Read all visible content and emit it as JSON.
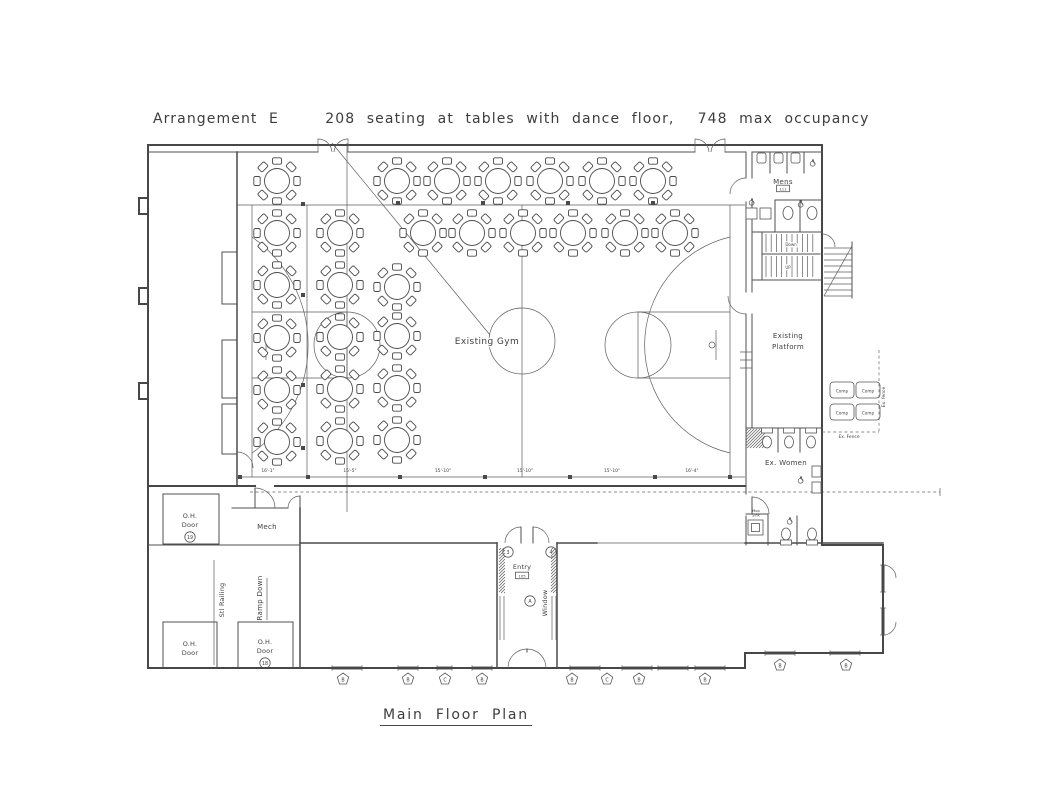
{
  "page": {
    "title": "Arrangement E    208 seating at tables with dance floor,  748 max occupancy",
    "caption": "Main Floor Plan"
  },
  "labels": {
    "existing_gym": "Existing Gym",
    "platform_line1": "Existing",
    "platform_line2": "Platform",
    "mens": "Mens",
    "ex_women": "Ex.  Women",
    "mech": "Mech",
    "entry": "Entry",
    "mop_line1": "Mop",
    "mop_line2": "Sink",
    "oh_door_line1": "O.H.",
    "oh_door_line2": "Door",
    "ramp_down": "Ramp  Down",
    "stl_railing": "Stl  Railing",
    "window": "Window",
    "stair_down": "Down",
    "stair_up": "UP",
    "comp": "Comp",
    "ex_fence_vertical": "Ex. fence",
    "ex_fence_horizontal": "Ex. Fence"
  },
  "plan": {
    "dimensions": [
      {
        "x": 268,
        "label": "16'-1\""
      },
      {
        "x": 350,
        "label": "15'-5\""
      },
      {
        "x": 443,
        "label": "15'-10\""
      },
      {
        "x": 525,
        "label": "15'-10\""
      },
      {
        "x": 612,
        "label": "15'-10\""
      },
      {
        "x": 692,
        "label": "16'-4\""
      }
    ],
    "dimension_ticks": [
      240,
      308,
      400,
      485,
      570,
      655,
      730
    ],
    "grid_squares": [
      [
        303,
        204
      ],
      [
        303,
        295
      ],
      [
        303,
        385
      ],
      [
        303,
        448
      ],
      [
        398,
        203
      ],
      [
        483,
        203
      ],
      [
        568,
        203
      ],
      [
        653,
        203
      ]
    ],
    "tables": {
      "seats_per_table": 8,
      "positions": [
        [
          277,
          181
        ],
        [
          397,
          181
        ],
        [
          447,
          181
        ],
        [
          498,
          181
        ],
        [
          550,
          181
        ],
        [
          602,
          181
        ],
        [
          653,
          181
        ],
        [
          277,
          233
        ],
        [
          340,
          233
        ],
        [
          423,
          233
        ],
        [
          472,
          233
        ],
        [
          523,
          233
        ],
        [
          573,
          233
        ],
        [
          625,
          233
        ],
        [
          675,
          233
        ],
        [
          277,
          285
        ],
        [
          277,
          338
        ],
        [
          277,
          390
        ],
        [
          277,
          442
        ],
        [
          340,
          285
        ],
        [
          340,
          337
        ],
        [
          340,
          389
        ],
        [
          340,
          441
        ],
        [
          397,
          287
        ],
        [
          397,
          336
        ],
        [
          397,
          388
        ],
        [
          397,
          440
        ]
      ]
    },
    "windows": {
      "horizontal": [
        [
          332,
          362,
          668
        ],
        [
          398,
          418,
          668
        ],
        [
          437,
          452,
          668
        ],
        [
          472,
          492,
          668
        ],
        [
          570,
          600,
          668
        ],
        [
          622,
          652,
          668
        ],
        [
          658,
          688,
          668
        ],
        [
          695,
          725,
          668
        ],
        [
          765,
          795,
          653
        ],
        [
          830,
          860,
          653
        ]
      ],
      "vertical": [
        [
          565,
          592,
          883
        ],
        [
          608,
          635,
          883
        ]
      ]
    },
    "window_tags": [
      {
        "x": 343,
        "y": 679,
        "t": "B"
      },
      {
        "x": 408,
        "y": 679,
        "t": "B"
      },
      {
        "x": 445,
        "y": 679,
        "t": "C"
      },
      {
        "x": 482,
        "y": 679,
        "t": "B"
      },
      {
        "x": 572,
        "y": 679,
        "t": "B"
      },
      {
        "x": 607,
        "y": 679,
        "t": "C"
      },
      {
        "x": 639,
        "y": 679,
        "t": "B"
      },
      {
        "x": 705,
        "y": 679,
        "t": "B"
      },
      {
        "x": 780,
        "y": 665,
        "t": "B"
      },
      {
        "x": 846,
        "y": 665,
        "t": "B"
      }
    ],
    "door_tags": [
      {
        "x": 190,
        "y": 537,
        "t": "19"
      },
      {
        "x": 265,
        "y": 663,
        "t": "18"
      },
      {
        "x": 508,
        "y": 552,
        "t": "3"
      },
      {
        "x": 551,
        "y": 552,
        "t": "4"
      },
      {
        "x": 530,
        "y": 601,
        "t": "A"
      }
    ],
    "room_numbers": [
      {
        "x": 522,
        "y": 577,
        "t": "105"
      },
      {
        "x": 783,
        "y": 190,
        "t": "111"
      }
    ],
    "comp_units": [
      [
        830,
        382
      ],
      [
        856,
        382
      ],
      [
        830,
        404
      ],
      [
        856,
        404
      ]
    ],
    "wheelchair_icons": [
      [
        813,
        163
      ],
      [
        752,
        202
      ],
      [
        801,
        204
      ],
      [
        801,
        480
      ],
      [
        790,
        521
      ]
    ]
  }
}
